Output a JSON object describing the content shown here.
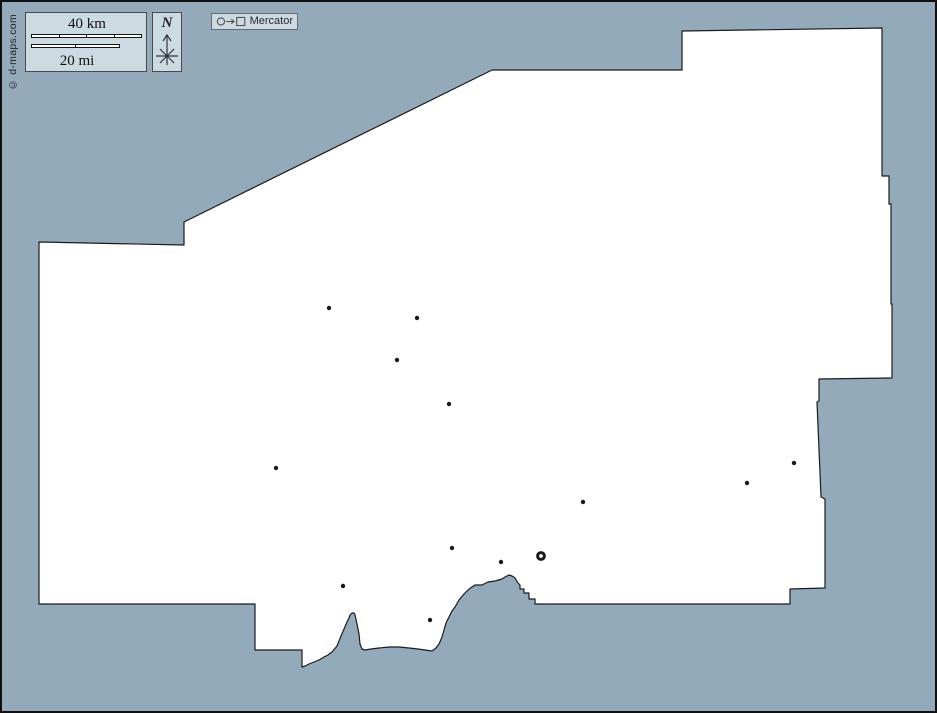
{
  "frame": {
    "width": 937,
    "height": 713
  },
  "colors": {
    "sea": "#93aaba",
    "land": "#ffffff",
    "outline": "#1b1b1b",
    "marker": "#1a1a1a",
    "panel_bg": "#ccdae1",
    "panel_border": "#4a4a4a"
  },
  "copyright": {
    "text": "© d-maps.com"
  },
  "scale_bar": {
    "km_label": "40 km",
    "mi_label": "20 mi",
    "km_segments": 4,
    "mi_segments": 2
  },
  "compass": {
    "north_label": "N"
  },
  "projection": {
    "label": "Mercator"
  },
  "map": {
    "outline": [
      [
        182,
        220
      ],
      [
        490,
        68
      ],
      [
        680,
        68
      ],
      [
        680,
        29
      ],
      [
        880,
        26
      ],
      [
        880,
        174
      ],
      [
        887,
        174
      ],
      [
        887,
        202
      ],
      [
        889,
        202
      ],
      [
        889,
        302
      ],
      [
        890,
        302
      ],
      [
        890,
        376
      ],
      [
        817,
        377
      ],
      [
        817,
        399
      ],
      [
        815,
        400
      ],
      [
        819,
        495
      ],
      [
        823,
        497
      ],
      [
        823,
        586
      ],
      [
        788,
        587
      ],
      [
        788,
        602
      ],
      [
        533,
        602
      ],
      [
        533,
        597
      ],
      [
        527,
        597
      ],
      [
        527,
        591
      ],
      [
        522,
        591
      ],
      [
        522,
        587
      ],
      [
        518,
        587
      ],
      [
        518,
        583
      ],
      [
        516,
        581
      ],
      [
        513,
        576
      ],
      [
        510,
        574
      ],
      [
        507,
        573
      ],
      [
        503,
        575
      ],
      [
        500,
        577
      ],
      [
        493,
        579
      ],
      [
        486,
        580
      ],
      [
        480,
        583
      ],
      [
        473,
        583
      ],
      [
        467,
        587
      ],
      [
        462,
        592
      ],
      [
        457,
        598
      ],
      [
        453,
        605
      ],
      [
        450,
        609
      ],
      [
        447,
        615
      ],
      [
        444,
        621
      ],
      [
        442,
        628
      ],
      [
        440,
        635
      ],
      [
        437,
        642
      ],
      [
        434,
        646
      ],
      [
        430,
        649
      ],
      [
        423,
        648
      ],
      [
        416,
        647
      ],
      [
        407,
        646
      ],
      [
        397,
        645
      ],
      [
        387,
        645
      ],
      [
        377,
        646
      ],
      [
        369,
        647
      ],
      [
        363,
        648
      ],
      [
        360,
        647
      ],
      [
        358,
        642
      ],
      [
        357,
        632
      ],
      [
        355,
        622
      ],
      [
        353,
        613
      ],
      [
        352,
        611
      ],
      [
        350,
        611
      ],
      [
        348,
        613
      ],
      [
        347,
        616
      ],
      [
        345,
        620
      ],
      [
        342,
        627
      ],
      [
        339,
        634
      ],
      [
        335,
        644
      ],
      [
        330,
        650
      ],
      [
        326,
        653
      ],
      [
        322,
        655
      ],
      [
        317,
        658
      ],
      [
        312,
        660
      ],
      [
        307,
        662
      ],
      [
        303,
        664
      ],
      [
        300,
        665
      ],
      [
        300,
        648
      ],
      [
        253,
        648
      ],
      [
        253,
        602
      ],
      [
        37,
        602
      ],
      [
        37,
        240
      ],
      [
        182,
        243
      ]
    ],
    "cities": [
      [
        327,
        306
      ],
      [
        415,
        316
      ],
      [
        395,
        358
      ],
      [
        447,
        402
      ],
      [
        274,
        466
      ],
      [
        581,
        500
      ],
      [
        745,
        481
      ],
      [
        792,
        461
      ],
      [
        450,
        546
      ],
      [
        499,
        560
      ],
      [
        341,
        584
      ],
      [
        428,
        618
      ]
    ],
    "capital": [
      539,
      554
    ]
  }
}
